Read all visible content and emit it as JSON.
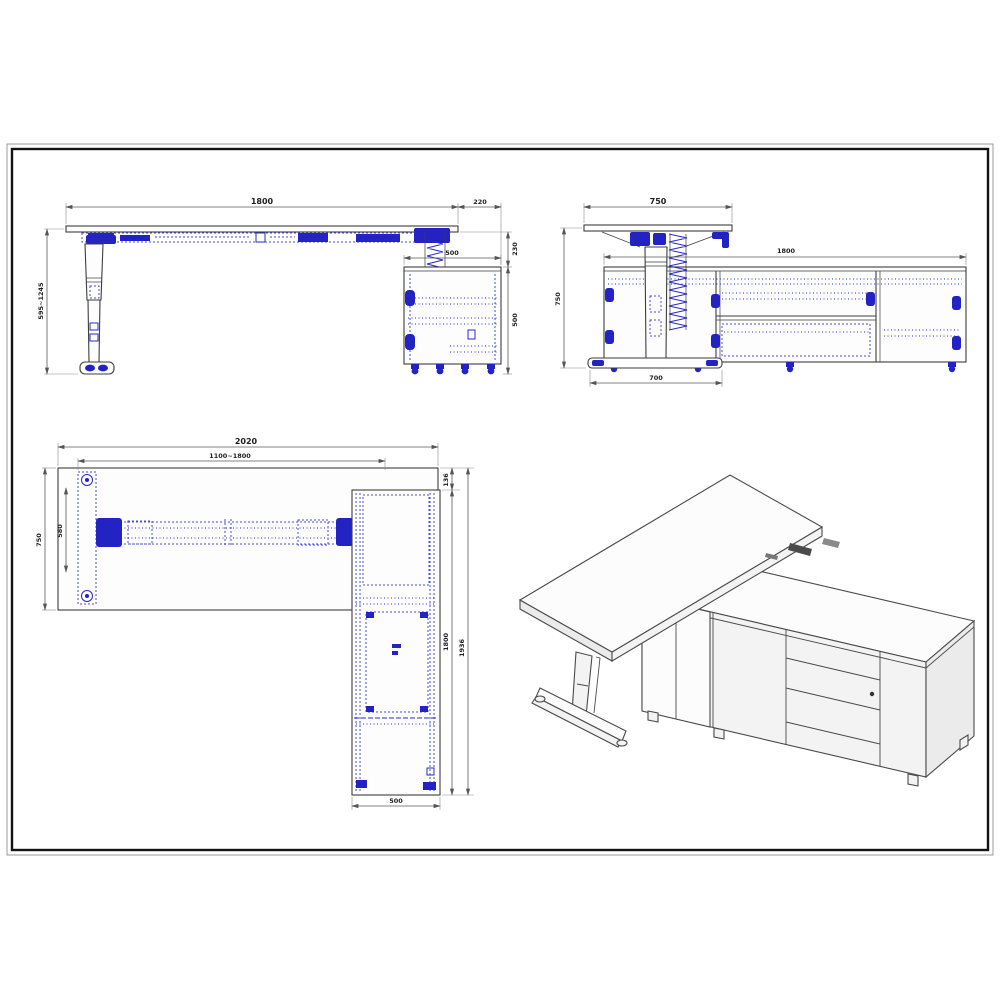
{
  "document": {
    "type": "furniture technical drawing",
    "subject": "height-adjustable L-shaped desk with side cabinet"
  },
  "colors": {
    "background": "#ffffff",
    "sheet_border": "#1a1a1a",
    "drawing_line": "#3d3d3d",
    "hardware_blue": "#2323c4",
    "dashed_blue": "#4a4ad4",
    "dimension_line": "#5a5a5a",
    "dimension_text": "#1e1e1e"
  },
  "views": {
    "front": {
      "label": "front elevation",
      "dims": {
        "top_length": "1800",
        "overhang": "220",
        "height_range": "595~1245",
        "top_gap": "230",
        "cabinet_height": "500",
        "cabinet_width": "500"
      }
    },
    "side": {
      "label": "side elevation",
      "dims": {
        "desk_depth": "750",
        "overall_height": "750",
        "cabinet_length": "1800",
        "foot_length": "700"
      }
    },
    "plan": {
      "label": "plan view",
      "dims": {
        "overall_length": "2020",
        "frame_range": "1100~1800",
        "desk_depth": "750",
        "foot_span": "580",
        "edge_offset": "136",
        "cabinet_length": "1800",
        "overall_depth": "1936",
        "cabinet_width": "500"
      }
    },
    "iso": {
      "label": "isometric view"
    }
  }
}
